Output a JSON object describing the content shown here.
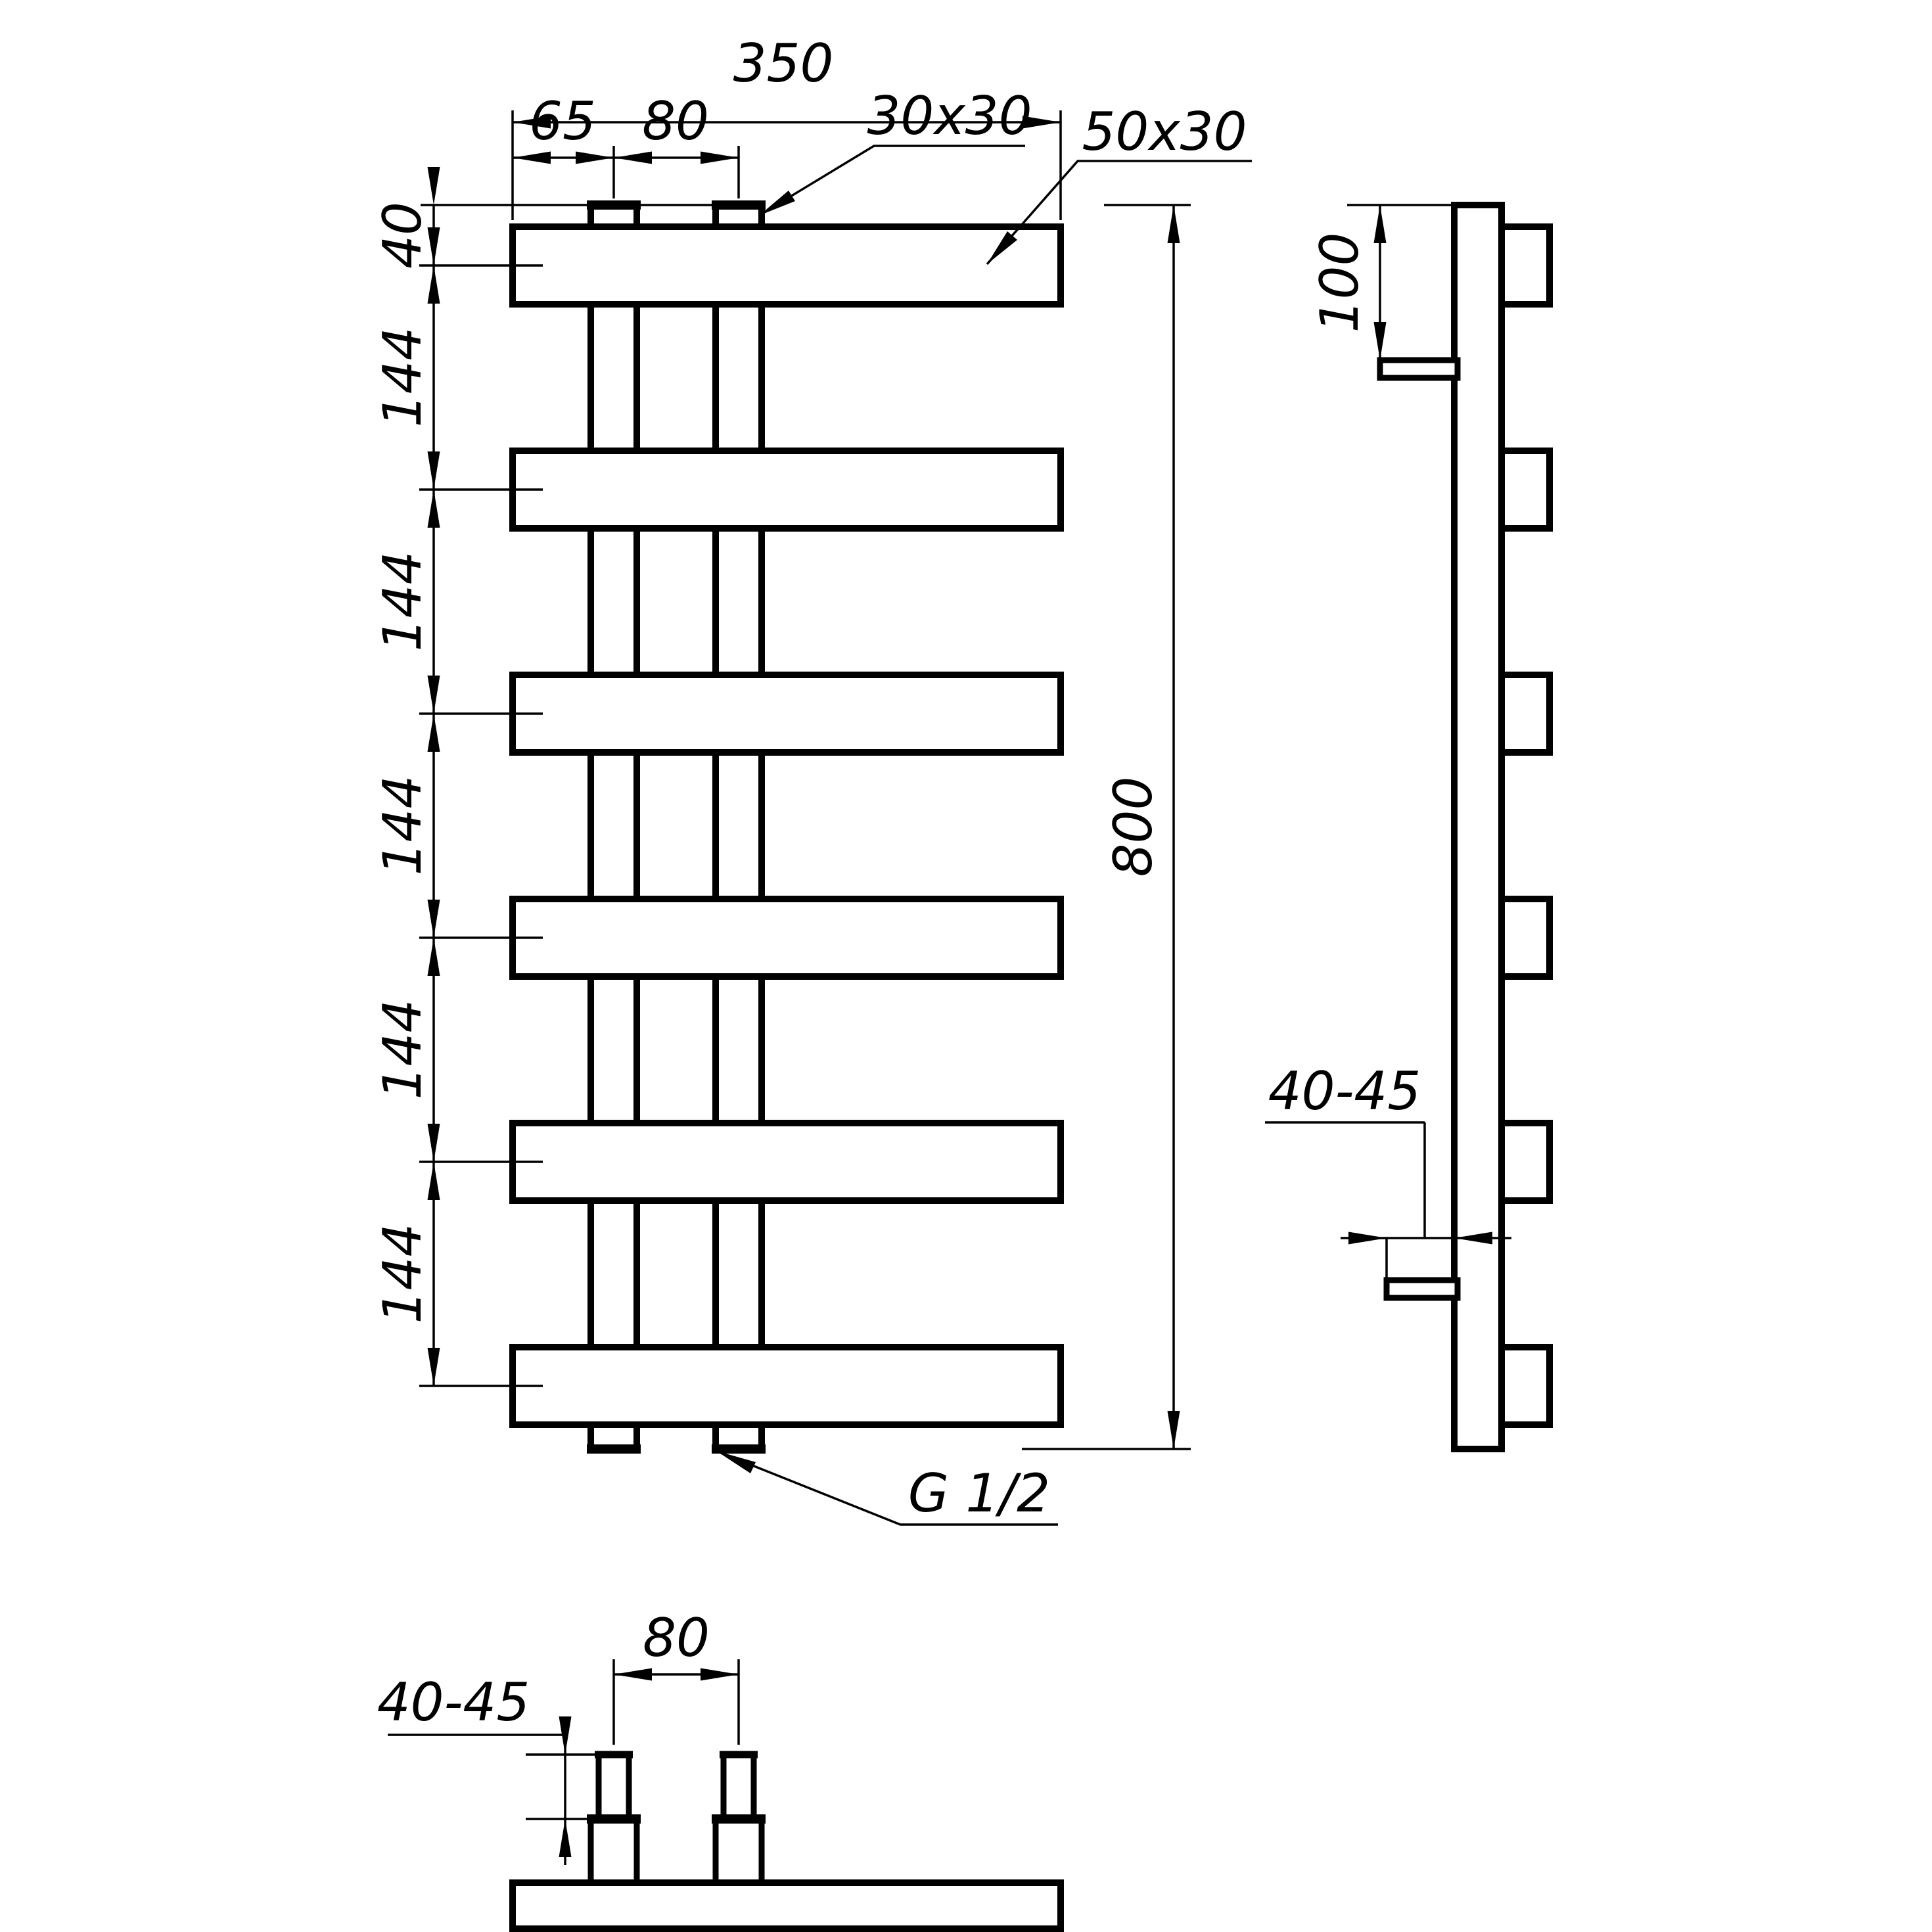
{
  "drawing": {
    "ink_color": "#000000",
    "paper_color": "#ffffff",
    "front_view": {
      "overall_width_label": "350",
      "left_tube_offset_label": "65",
      "tube_spacing_label": "80",
      "tube_profile_label": "30x30",
      "bar_profile_label": "50x30",
      "top_offset_label": "40",
      "bar_spacing_labels": [
        "144",
        "144",
        "144",
        "144",
        "144"
      ],
      "overall_height_label": "800",
      "thread_label": "G 1/2"
    },
    "side_view": {
      "bracket_top_offset_label": "100",
      "wall_distance_label": "40-45"
    },
    "bottom_view": {
      "thread_length_label": "40-45",
      "tube_spacing_label": "80"
    }
  }
}
